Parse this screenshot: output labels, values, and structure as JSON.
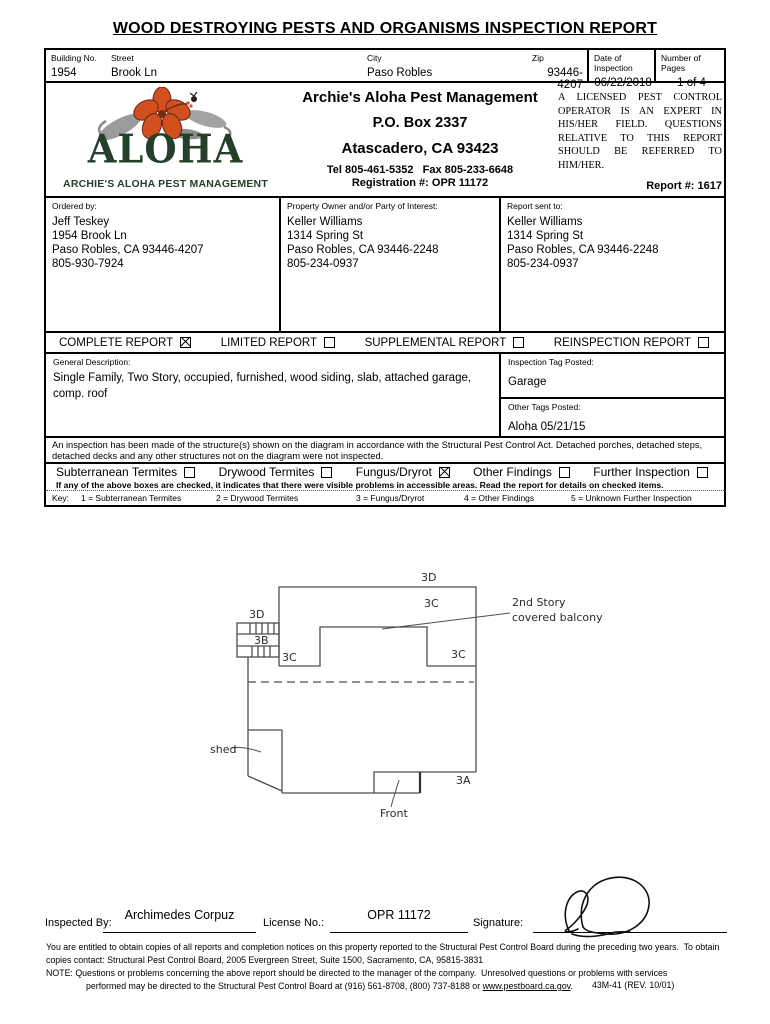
{
  "title": "WOOD DESTROYING PESTS AND ORGANISMS INSPECTION REPORT",
  "address_row": {
    "building_no": {
      "label": "Building No.",
      "value": "1954"
    },
    "street": {
      "label": "Street",
      "value": "Brook Ln"
    },
    "city": {
      "label": "City",
      "value": "Paso Robles"
    },
    "zip": {
      "label": "Zip",
      "value": "93446-4207"
    },
    "date": {
      "label": "Date of Inspection",
      "value": "06/22/2018"
    },
    "pages": {
      "label": "Number of Pages",
      "value": "1 of 4"
    }
  },
  "company": {
    "logo_word": "ALOHA",
    "logo_sub": "ARCHIE'S ALOHA PEST MANAGEMENT",
    "name": "Archie's Aloha Pest Management",
    "po_box": "P.O. Box 2337",
    "city_line": "Atascadero, CA 93423",
    "tel_fax": "Tel 805-461-5352   Fax 805-233-6648",
    "registration": "Registration #: OPR 11172",
    "licensed_text": "A LICENSED PEST CONTROL OPERATOR IS AN EXPERT IN HIS/HER FIELD. QUESTIONS RELATIVE TO THIS REPORT SHOULD BE REFERRED TO HIM/HER.",
    "report_no": "Report #: 1617",
    "colors": {
      "logo_green": "#24402a",
      "flower_orange": "#d2501f",
      "leaf_gray": "#999999"
    }
  },
  "parties": [
    {
      "label": "Ordered by:",
      "lines": [
        "Jeff Teskey",
        "1954 Brook Ln",
        "Paso Robles, CA 93446-4207",
        "805-930-7924"
      ]
    },
    {
      "label": "Property Owner and/or Party of Interest:",
      "lines": [
        "Keller Williams",
        "1314 Spring St",
        "Paso Robles, CA 93446-2248",
        "805-234-0937"
      ]
    },
    {
      "label": "Report sent to:",
      "lines": [
        "Keller Williams",
        "1314 Spring St",
        "Paso Robles, CA 93446-2248",
        "805-234-0937"
      ]
    }
  ],
  "report_types": [
    {
      "label": "COMPLETE REPORT",
      "checked": true
    },
    {
      "label": "LIMITED REPORT",
      "checked": false
    },
    {
      "label": "SUPPLEMENTAL REPORT",
      "checked": false
    },
    {
      "label": "REINSPECTION REPORT",
      "checked": false
    }
  ],
  "description": {
    "label": "General Description:",
    "text": "Single Family, Two Story, occupied, furnished, wood siding, slab, attached garage, comp. roof",
    "tag_label": "Inspection Tag Posted:",
    "tag_value": "Garage",
    "other_label": "Other Tags Posted:",
    "other_value": "Aloha 05/21/15"
  },
  "inspection_note": "An inspection has been made of the structure(s) shown on the diagram in accordance with the Structural Pest Control Act. Detached porches, detached steps, detached decks and any other structures not on the diagram were not inspected.",
  "findings": {
    "items": [
      {
        "label": "Subterranean Termites",
        "checked": false
      },
      {
        "label": "Drywood Termites",
        "checked": false
      },
      {
        "label": "Fungus/Dryrot",
        "checked": true
      },
      {
        "label": "Other Findings",
        "checked": false
      },
      {
        "label": "Further Inspection",
        "checked": false
      }
    ],
    "note": "If any of the above boxes are checked, it indicates that there were visible problems in accessible areas. Read the report for details on checked items."
  },
  "key_row": {
    "label": "Key:",
    "items": [
      "1 = Subterranean Termites",
      "2 = Drywood Termites",
      "3 = Fungus/Dryrot",
      "4 = Other Findings",
      "5 = Unknown Further Inspection"
    ]
  },
  "diagram": {
    "top_3d": "3D",
    "top_3c": "3C",
    "left_3d": "3D",
    "left_3b": "3B",
    "left_3c": "3C",
    "right_3c": "3C",
    "bottom_3a": "3A",
    "balcony_line1": "2nd Story",
    "balcony_line2": "covered balcony",
    "shed_label": "shed",
    "front_label": "Front"
  },
  "signature_row": {
    "inspected_by_label": "Inspected By:",
    "inspected_by_value": "Archimedes Corpuz",
    "license_label": "License No.:",
    "license_value": "OPR 11172",
    "signature_label": "Signature:"
  },
  "footer": {
    "para1_line1": "You are entitled to obtain copies of all reports and completion notices on this property reported to the Structural Pest Control Board during the preceding two years.  To obtain",
    "para1_line2": "copies contact: Structural Pest Control Board, 2005 Evergreen Street, Suite 1500, Sacramento, CA, 95815-3831",
    "note_line1": "NOTE: Questions or problems concerning the above report should be directed to the manager of the company.  Unresolved questions or problems with services",
    "note_line2_pre": "performed may be directed to the Structural Pest Control Board at (916) 561-8708, (800) 737-8188 or ",
    "note_link": "www.pestboard.ca.gov",
    "note_line2_post": ".",
    "form_no": "43M-41 (REV. 10/01)"
  }
}
